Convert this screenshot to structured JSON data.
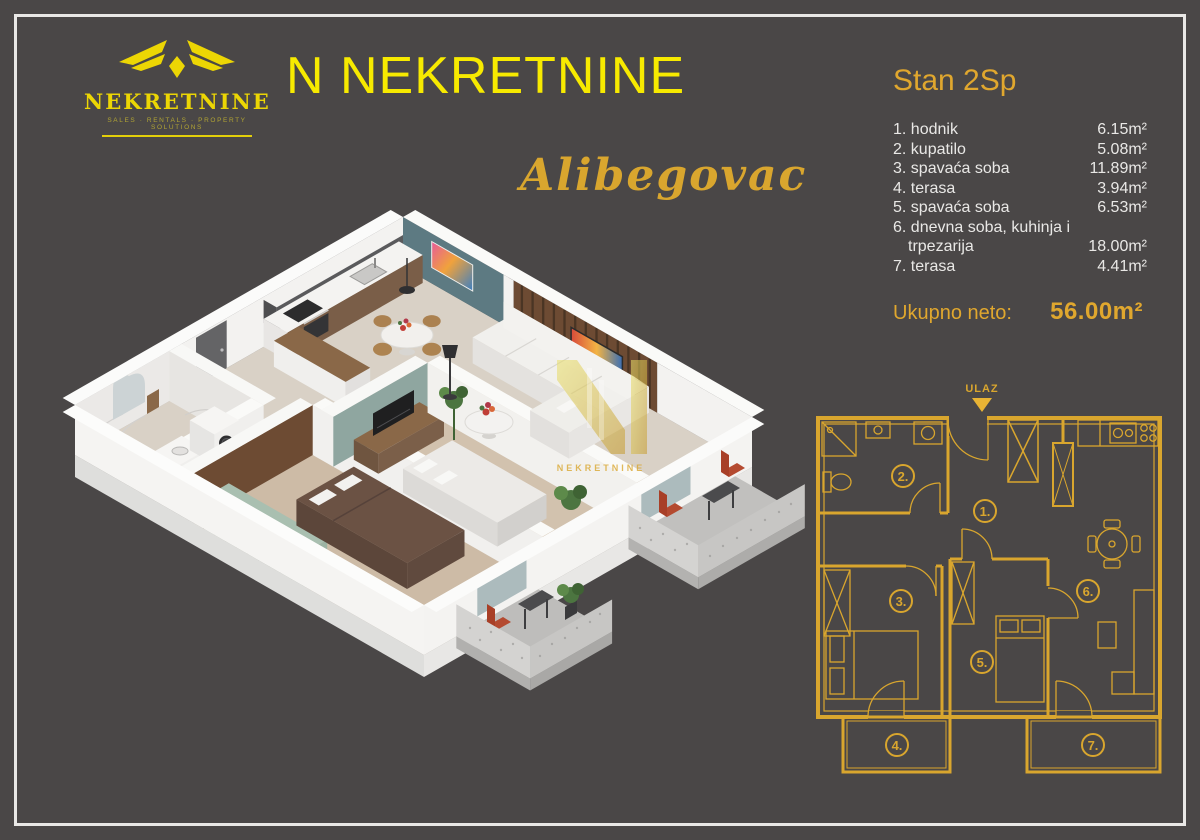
{
  "theme": {
    "background": "#4a4747",
    "frame_border": "#e9e8e6",
    "title_yellow": "#f7ea00",
    "logo_yellow": "#ecd604",
    "gold": "#d9a62e",
    "list_text": "#e9e8e6"
  },
  "logo": {
    "name": "NEKRETNINE",
    "tagline": "SALES · RENTALS · PROPERTY SOLUTIONS"
  },
  "header": {
    "title": "N NEKRETNINE",
    "location": "Alibegovac"
  },
  "unit": {
    "title": "Stan 2Sp",
    "rooms": [
      {
        "name": "1. hodnik",
        "area": "6.15m²"
      },
      {
        "name": "2. kupatilo",
        "area": "5.08m²"
      },
      {
        "name": "3. spavaća soba",
        "area": "11.89m²"
      },
      {
        "name": "4. terasa",
        "area": "3.94m²"
      },
      {
        "name": "5. spavaća soba",
        "area": "6.53m²"
      },
      {
        "name": "6. dnevna soba, kuhinja i trpezarija",
        "area": "18.00m²"
      },
      {
        "name": "7. terasa",
        "area": "4.41m²"
      }
    ],
    "total_label": "Ukupno neto:",
    "total_area": "56.00m²"
  },
  "floorplan": {
    "entrance_label": "ULAZ",
    "room_numbers": [
      "1.",
      "2.",
      "3.",
      "4.",
      "5.",
      "6.",
      "7."
    ]
  },
  "watermark": {
    "text": "NEKRETNINE"
  }
}
